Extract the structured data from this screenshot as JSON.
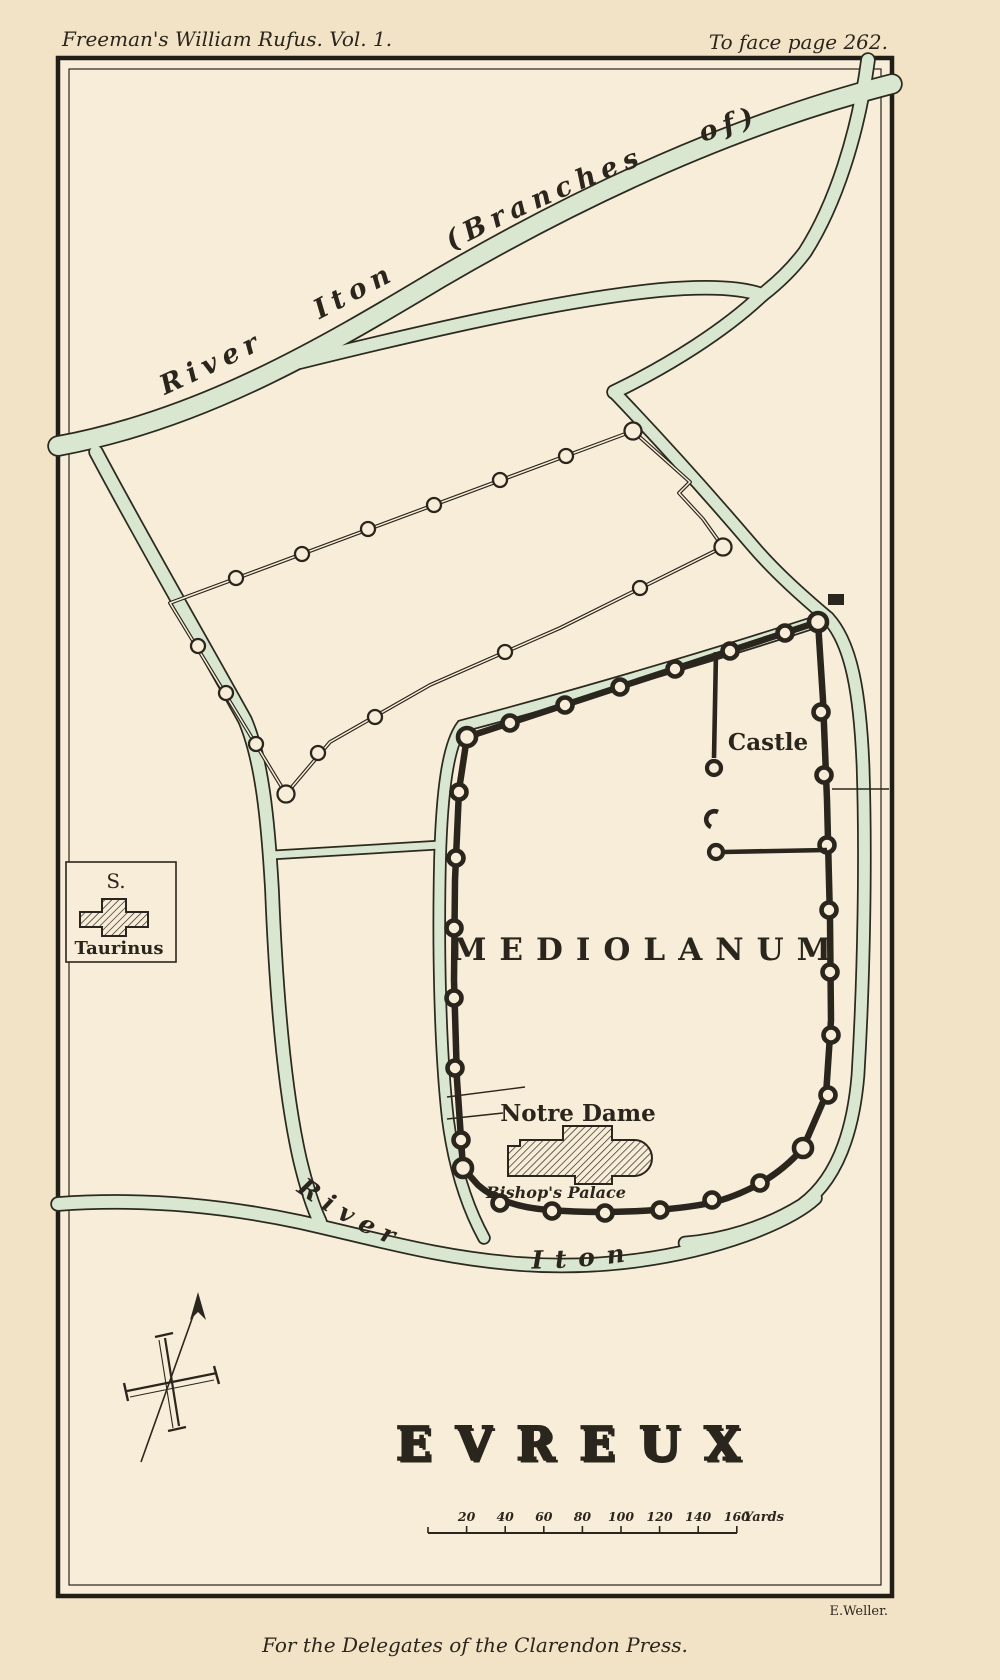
{
  "page": {
    "header_left": "Freeman's William Rufus. Vol. 1.",
    "header_right": "To face page 262.",
    "footer_center": "For the Delegates of the Clarendon Press.",
    "engraver": "E.Weller."
  },
  "map": {
    "title": "EVREUX",
    "labels": {
      "river_upper": "River Iton (Branches of)",
      "river_lower_1": "River",
      "river_lower_2": "Iton",
      "city": "MEDIOLANUM",
      "castle": "Castle",
      "notre_dame": "Notre Dame",
      "bishops_palace": "Bishop's Palace",
      "st_taurinus_top": "S.",
      "st_taurinus_bottom": "Taurinus"
    },
    "scale": {
      "ticks": [
        "20",
        "40",
        "60",
        "80",
        "100",
        "120",
        "140",
        "160"
      ],
      "unit": "Yards"
    },
    "colors": {
      "paper": "#f2e3c6",
      "map_bg": "#f8edd8",
      "ink": "#2b261d",
      "river_fill": "#d9e7d1"
    }
  }
}
